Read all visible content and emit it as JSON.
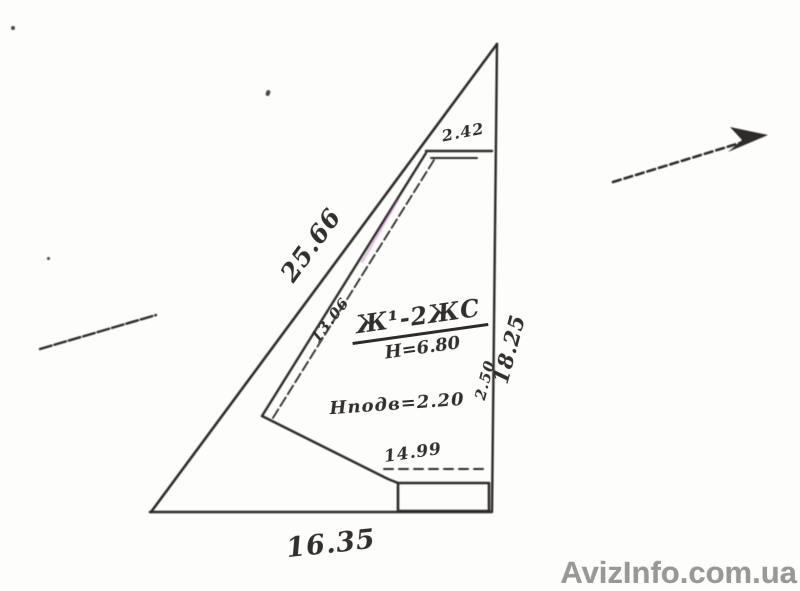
{
  "drawing": {
    "title": "land-plot-survey-sketch",
    "dimensions": {
      "hypotenuse": "25.66",
      "right_side": "18.25",
      "bottom_side": "16.35",
      "top_offset": "2.42",
      "right_inner": "2.50",
      "left_inner": "13.06",
      "bottom_inner": "14.99"
    },
    "building": {
      "designation": "Ж¹-2ЖС",
      "height": "Н=6.80",
      "basement_height": "Нподв=2.20"
    },
    "colors": {
      "ink": "#2e2b28",
      "paper": "#fdfdfc",
      "tint": "#c05ac0"
    }
  },
  "watermark": {
    "text": "AvizInfo.com.ua",
    "color": "#989898"
  }
}
